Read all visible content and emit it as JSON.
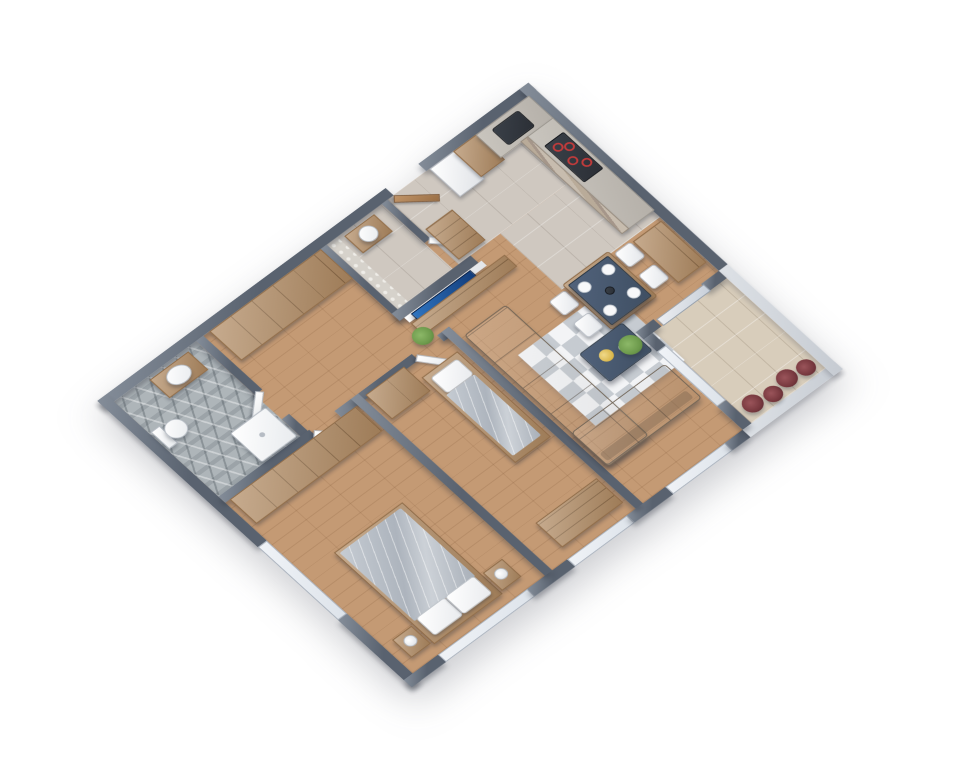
{
  "scene": {
    "description": "3D isometric rendering of a one-floor apartment plan on a white background",
    "view": {
      "rotation_deg": -42,
      "vertical_scale": 0.82
    }
  },
  "palette": {
    "canvas": "#ffffff",
    "wall": "#59626f",
    "wallEdge": "#848d99",
    "parapet": "#c6cbd2",
    "windowGlass": "#dde3ea",
    "wood": "#c49a74",
    "cabinet": "#b08a62",
    "cabinetLine": "#8f6c49",
    "stoneFloor": "#cfc8c0",
    "bathTile": "#aeb5b9",
    "balconyTile": "#d8cdbb",
    "counter": "#b5b0a9",
    "sofa": "#8d8172",
    "rug": "#e4e7ea",
    "navyTable": "#3f4f63",
    "gold": "#d9b64a",
    "whiteFixture": "#f4f5f6",
    "duvet": "#bcc2c9",
    "tvBlue1": "#2f74c0",
    "tvBlue2": "#123c7a",
    "plantGreen": "#6d9a4c",
    "shrubRed": "#77383e",
    "applianceDark": "#2b2f36",
    "burnerRed": "#c23b3b"
  },
  "rooms": [
    {
      "id": "entry",
      "floor": "stone-tile",
      "items": [
        "entry-door",
        "hall-cabinet"
      ]
    },
    {
      "id": "hallway",
      "floor": "wood-plank",
      "items": [
        "closet-row",
        "bathroom-door",
        "master-door",
        "bedroom2-door"
      ]
    },
    {
      "id": "wc",
      "floor": "stone-tile",
      "items": [
        "vanity-sink",
        "pebble-accent-wall",
        "wc-door"
      ]
    },
    {
      "id": "bathroom",
      "floor": "diamond-tile",
      "items": [
        "vanity-sink",
        "toilet",
        "shower-tray"
      ]
    },
    {
      "id": "kitchen",
      "floor": "stone-tile",
      "items": [
        "fridge",
        "pantry-cabinet",
        "counter-sink",
        "cooktop",
        "l-shaped-counter",
        "stone-front-cabinets"
      ]
    },
    {
      "id": "dining",
      "floor": "wood-plank",
      "items": [
        "dining-table",
        "plates-x4",
        "chairs-x4",
        "buffet-cabinet"
      ]
    },
    {
      "id": "living",
      "floor": "wood-plank",
      "items": [
        "corner-sofa",
        "coffee-table",
        "gold-tray",
        "patch-rug",
        "tv",
        "media-console",
        "console-plant",
        "corner-plant"
      ]
    },
    {
      "id": "master-bedroom",
      "floor": "wood-plank",
      "items": [
        "double-bed",
        "pillows-x2",
        "nightstand-left",
        "nightstand-right",
        "lamps-x2",
        "wardrobe-row",
        "windows"
      ]
    },
    {
      "id": "bedroom-2",
      "floor": "wood-plank",
      "items": [
        "single-bed",
        "pillow",
        "wardrobe",
        "desk",
        "window"
      ]
    },
    {
      "id": "balcony",
      "floor": "beige-tile",
      "items": [
        "sliding-glass-door",
        "red-shrubs-x4",
        "parapet"
      ]
    }
  ]
}
